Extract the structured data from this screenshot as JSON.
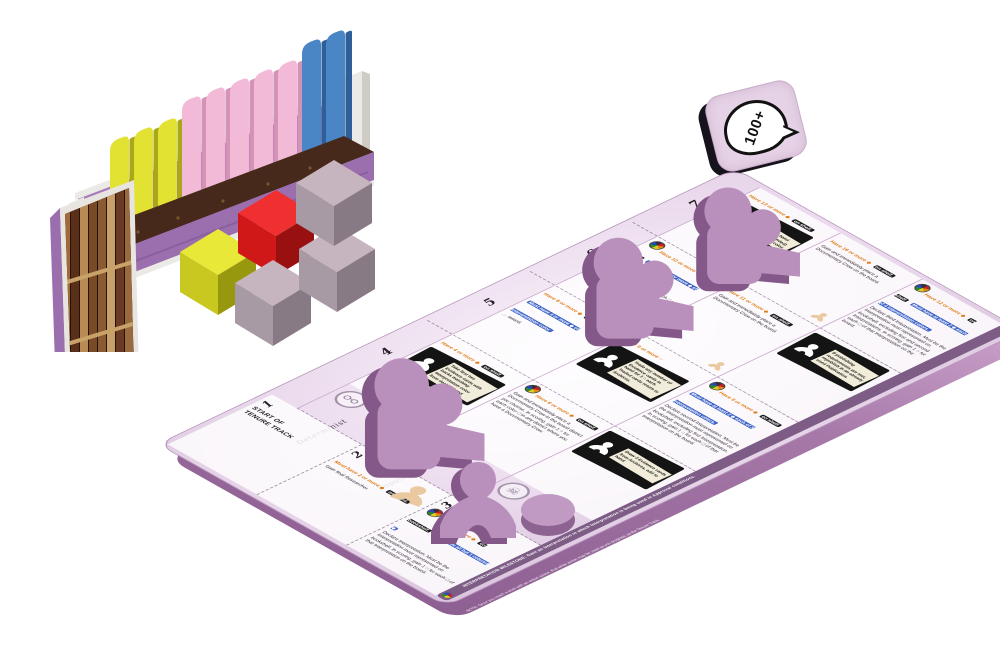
{
  "scene": {
    "description": "Board game components: bookshelf rack with book tiles, resource cubes, a 100+ score tile, and a Tenure Track player board with purple wooden pieces"
  },
  "token": {
    "label": "100+"
  },
  "bookshelf": {
    "book_tiles": [
      "yellow",
      "yellow",
      "yellow",
      "pink",
      "pink",
      "pink",
      "pink",
      "pink",
      "blue",
      "blue"
    ],
    "cubes": [
      "yellow",
      "red",
      "mauve",
      "mauve",
      "mauve"
    ],
    "colors": {
      "yellow": "#e2e232",
      "pink": "#f2bad6",
      "blue": "#4a86c6",
      "red": "#e42525",
      "mauve": "#bcaab4"
    }
  },
  "board": {
    "accent_orange": "#e07b12",
    "chip_blue": "#3d63c6",
    "meeple_purple": "#b78bb9",
    "row_numbers": [
      "7",
      "6",
      "5",
      "4"
    ],
    "columns": [
      {
        "name": "Determinist",
        "stamp": "glasses"
      },
      {
        "name": "Popularizer",
        "stamp": "heart"
      },
      {
        "name": "",
        "stamp": "skull"
      }
    ],
    "grid": [
      {
        "num": "7",
        "cells": [
          {
            "have": "Have 13 or more ◆",
            "chip": "on shelf.",
            "box": "Change 2 □ in hand (funded or unfunded) to Interpretation color."
          },
          {
            "have": "Have 16 or more ◆",
            "chip": "on shelf.",
            "body": "Gain and immediately place a Documentary Crew on the board."
          },
          {
            "have": "Have 12 or more ◆",
            "chip": "on shelf.",
            "must": "Must have at least 2 ◆ each of 4 Interpretation colors.",
            "body": "Declare third Interpretation. Must be the Interpretation most represented on bookshelf, excluding first and second Interpretations. In scoring, gain 1 ○ for each □ of that Interpretation on the board."
          }
        ]
      },
      {
        "num": "6",
        "cells": [
          {
            "have": "Have 10 or more ◆",
            "chip": "on shelf.",
            "must": "Must have 7 or more ◆ of Interpretation color.",
            "body": "Now gain 2 ○ in scoring for each □ on the model of Interpretation color."
          },
          {
            "have": "Have 11 or more ◆",
            "chip": "on shelf.",
            "body": "Gain and immediately place a Documentary Crew on the board."
          },
          {
            "box": "If publishing requirements are met, republish in an already used Publication."
          }
        ]
      },
      {
        "num": "5",
        "cells": [
          {
            "have": "Have 8 or more ◆",
            "chip": "on shelf.",
            "must": "Must have 4 or more ◆ of Interpretation color.",
            "body": "… award."
          },
          {
            "have": "Have 9 or more ○",
            "box": "Trade any number of Evidence cards in hand for 1 ○ each. Traded cards return to Archives."
          },
          {
            "have": "Have 9 or more ◆",
            "chip": "on shelf.",
            "must": "Must have at least 2 ◆ each of 3 Interpretation colors.",
            "body": "Declare second Interpretation. Must be the Interpretation most represented on bookshelf, excluding first Interpretation. In scoring, gain 1 ○ for each □ of that Interpretation on the board."
          }
        ]
      },
      {
        "num": "4",
        "cells": [
          {
            "have": "Have 4 or more ◆",
            "chip": "on shelf.",
            "box": "Take first two Evidence cards with backs matching Interpretation color from deck to hand."
          },
          {
            "have": "Have 6 or more ◆",
            "chip": "on shelf.",
            "body": "Gain and immediately place a Documentary Crew in the board district you choose. In scoring, gain 1 ○ for each color □ in any district where you have a Documentary Crew."
          },
          {
            "box": "Draw 3 Evidence cards from Archives, add to hand."
          }
        ]
      }
    ],
    "start_cells": [
      {
        "num": "1",
        "line1": "START OF",
        "line2": "TENURE TRACK"
      },
      {
        "num": "2",
        "have": "Must have 2 or more ◆",
        "chip": "on board.",
        "body": "Gain final Researcher."
      },
      {
        "num": "3",
        "have": "Have 4 or more ◆",
        "chip": "on bookshelf.",
        "must": "Must have all but 1 colored ◆",
        "body": "Declare Interpretation. Must be the Interpretation most represented on bookshelf. In scoring, gain 1 ○ for each □ of that Interpretation on the board."
      }
    ],
    "footer": "INTERPRETATION MILESTONE: Gain an Interpretation in which Interpretation is being used in Approval conditions.",
    "side_note": "NOTE: Once you reach a level with an action space, that white action may be used as you progress up the Tenure Track."
  }
}
